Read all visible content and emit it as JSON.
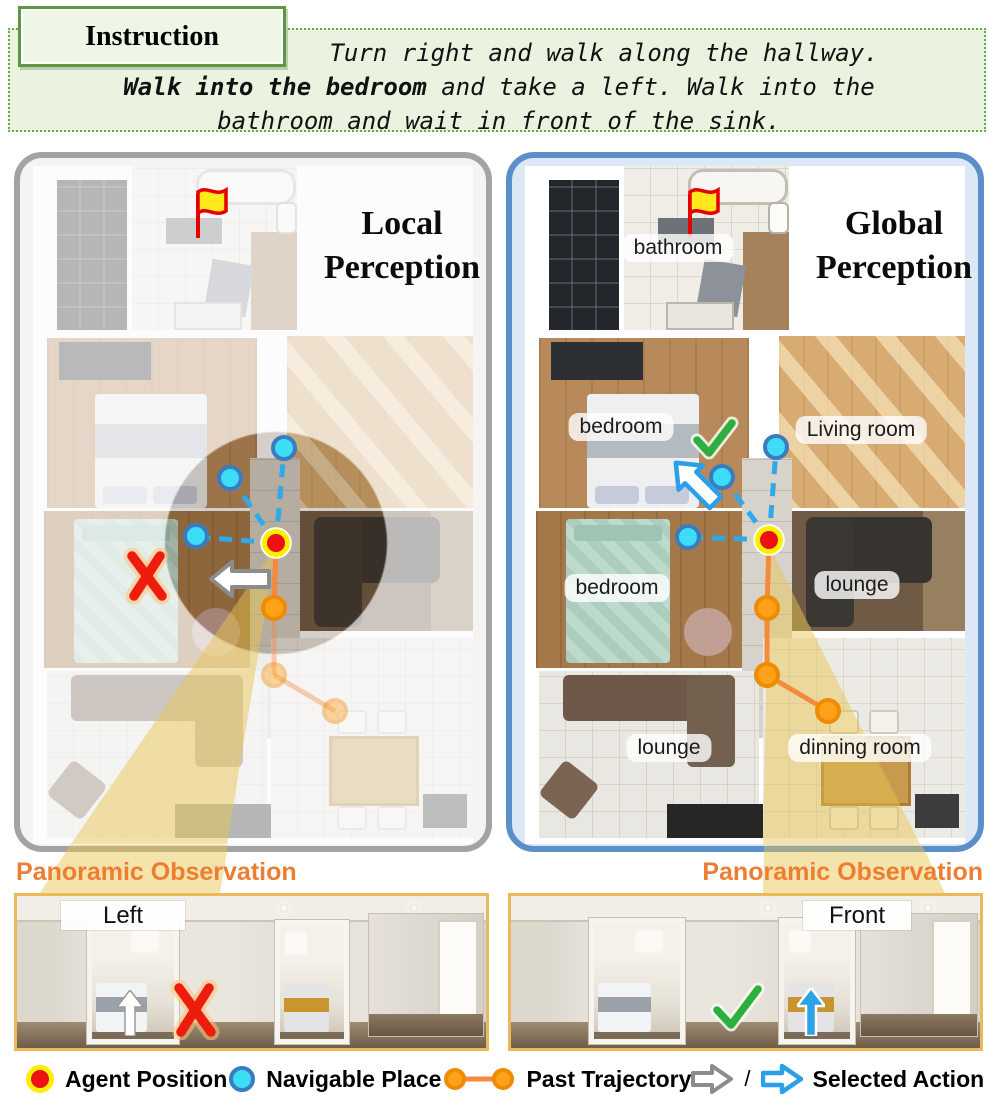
{
  "instruction": {
    "label": "Instruction",
    "line1": "Turn right and walk along the hallway.",
    "line2_bold": "Walk into the bedroom",
    "line2_rest": " and take a left. Walk into the",
    "line3": "bathroom and wait in front of the sink."
  },
  "local_panel": {
    "title_line1": "Local",
    "title_line2": "Perception",
    "pano_title": "Panoramic Observation",
    "pano_view_label": "Left"
  },
  "global_panel": {
    "title_line1": "Global",
    "title_line2": "Perception",
    "pano_title": "Panoramic Observation",
    "pano_view_label": "Front",
    "room_labels": {
      "bathroom": "bathroom",
      "bedroom_upper": "bedroom",
      "living_room": "Living room",
      "bedroom_lower": "bedroom",
      "lounge_upper": "lounge",
      "lounge_lower": "lounge",
      "dining_room": "dinning room"
    }
  },
  "legend": {
    "agent_label": "Agent Position",
    "navigable_label": "Navigable Place",
    "trajectory_label": "Past Trajectory",
    "action_separator": "/",
    "action_label": "Selected Action"
  },
  "colors": {
    "agent_red": "#ee1111",
    "agent_ring": "#ffee00",
    "navigable_fill": "#3ddcf7",
    "navigable_border": "#3a7cc0",
    "navigable_line": "#2fa9e9",
    "trajectory_fill": "#ffa219",
    "trajectory_border": "#ef8b00",
    "trajectory_line": "#f5893c",
    "action_gray": "#8c8c8c",
    "action_blue": "#2b9fe8",
    "cone_yellow": "#e8c44f",
    "check_green": "#2eae3e",
    "cross_red": "#ee1c0c",
    "panel_local_border": "#a3a3a3",
    "panel_local_bg": "#f5f4f3",
    "panel_global_border": "#5b8fc9",
    "panel_global_bg": "#dce8f6",
    "instruction_green": "#6aa84f",
    "instruction_bg": "#eaf3df",
    "pano_border": "#e9b95c",
    "title_orange": "#ed7d31"
  }
}
